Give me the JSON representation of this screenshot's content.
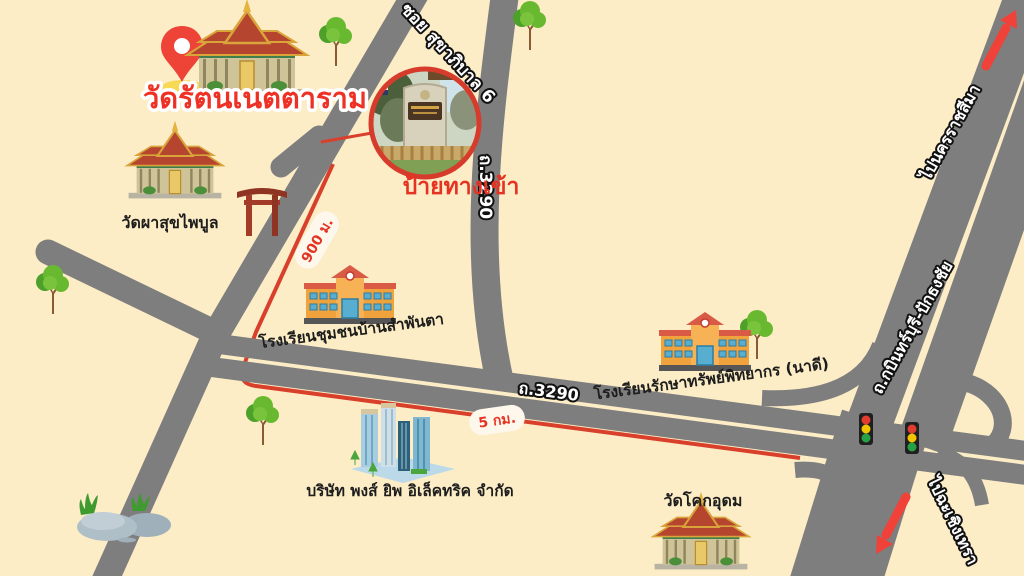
{
  "title": "วัดรัตนเนตตาราม",
  "colors": {
    "background": "#fcedc6",
    "road": "#7e7e7e",
    "route_red": "#d8402c",
    "accent_red": "#ee3124",
    "pill_bg": "#fdf7ec"
  },
  "roads": {
    "soi_label": "ซอย สุขาภิบาล 6",
    "route_3290_vertical": "ถ.3290",
    "route_3290_horizontal": "ถ.3290",
    "highway_label": "ถ.กบินทร์บุรี-ปักธงชัย"
  },
  "directions": {
    "to_north": "ไปนครราชสีมา",
    "to_south": "ไปฉะเชิงเทรา"
  },
  "distances": {
    "temple_road": "900 ม.",
    "main_road": "5 กม."
  },
  "places": {
    "main_temple": "วัดรัตนเนตตาราม",
    "temple_phasuk": "วัดผาสุขไพบูล",
    "temple_khok_udom": "วัดโคกอุดม",
    "school_sampanta": "โรงเรียนชุมชนบ้านสำพันตา",
    "school_raksasap": "โรงเรียนรักษาทรัพย์พิทยากร (นาดี)",
    "company": "บริษัท พงส์ ยิพ อิเล็คทริค จำกัด"
  },
  "inset": {
    "caption": "ป้ายทางเข้า"
  }
}
